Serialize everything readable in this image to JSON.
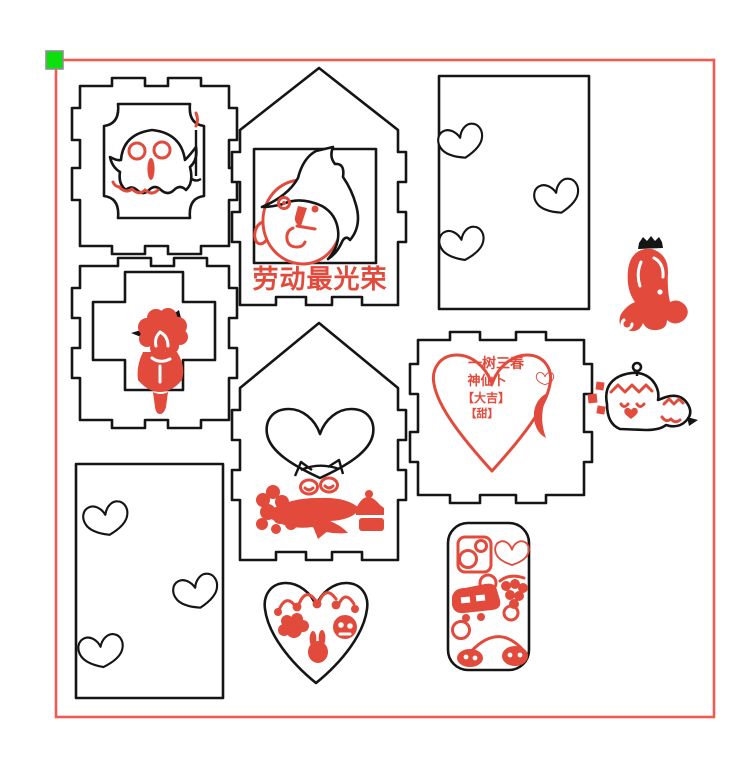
{
  "scene": {
    "type": "laser-engraver-workspace-canvas",
    "background": "#ffffff"
  },
  "colors": {
    "cut_line_black": "#151515",
    "engrave_red": "#e24a3c",
    "work_area_frame_red": "#f05a50",
    "origin_marker_green": "#0ce00c",
    "origin_marker_border": "#8f8f8f"
  },
  "texts": {
    "house_banner": "劳动最光荣",
    "heart_panel": {
      "line1": "一树三春",
      "line2": "神仙卜",
      "line3": "【大吉】",
      "line4": "【甜】"
    }
  }
}
